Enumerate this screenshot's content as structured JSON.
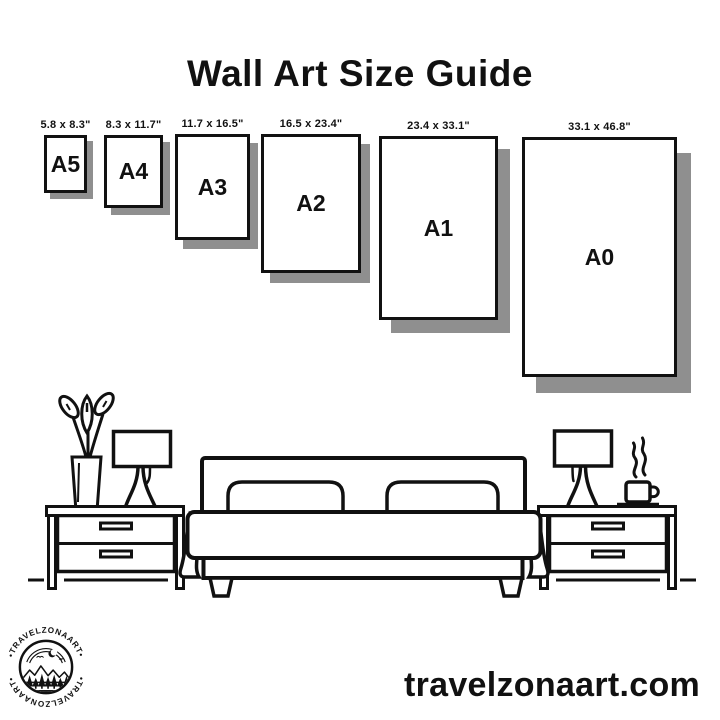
{
  "title": "Wall Art Size Guide",
  "sizes": [
    {
      "name": "A5",
      "dimensions": "5.8 x 8.3\""
    },
    {
      "name": "A4",
      "dimensions": "8.3 x 11.7\""
    },
    {
      "name": "A3",
      "dimensions": "11.7 x 16.5\""
    },
    {
      "name": "A2",
      "dimensions": "16.5 x 23.4\""
    },
    {
      "name": "A1",
      "dimensions": "23.4 x 33.1\""
    },
    {
      "name": "A0",
      "dimensions": "33.1 x 46.8\""
    }
  ],
  "brand": {
    "logo_text_top": "•TRAVELZONAART•",
    "logo_text_bottom": "•TRAVELZONAART•",
    "website": "travelzonaart.com"
  },
  "colors": {
    "ink": "#111111",
    "shadow": "#8f8f8f",
    "background": "#ffffff"
  }
}
